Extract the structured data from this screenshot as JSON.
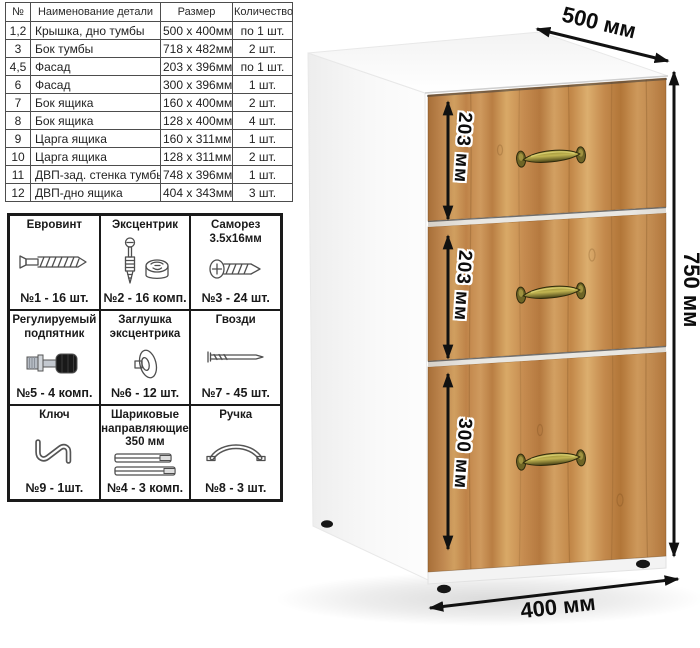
{
  "parts_table": {
    "headers": {
      "num": "№",
      "name": "Наименование детали",
      "size": "Размер",
      "qty": "Количество"
    },
    "rows": [
      {
        "num": "1,2",
        "name": "Крышка, дно тумбы",
        "size": "500 х 400мм",
        "qty": "по 1 шт."
      },
      {
        "num": "3",
        "name": "Бок тумбы",
        "size": "718 х 482мм",
        "qty": "2 шт."
      },
      {
        "num": "4,5",
        "name": "Фасад",
        "size": "203 х 396мм",
        "qty": "по 1 шт."
      },
      {
        "num": "6",
        "name": "Фасад",
        "size": "300 х 396мм",
        "qty": "1 шт."
      },
      {
        "num": "7",
        "name": "Бок ящика",
        "size": "160 х 400мм",
        "qty": "2 шт."
      },
      {
        "num": "8",
        "name": "Бок ящика",
        "size": "128 х 400мм",
        "qty": "4 шт."
      },
      {
        "num": "9",
        "name": "Царга ящика",
        "size": "160 х 311мм",
        "qty": "1 шт."
      },
      {
        "num": "10",
        "name": "Царга ящика",
        "size": "128 х 311мм",
        "qty": "2 шт."
      },
      {
        "num": "11",
        "name": "ДВП-зад. стенка тумбы",
        "size": "748 х 396мм",
        "qty": "1 шт."
      },
      {
        "num": "12",
        "name": "ДВП-дно ящика",
        "size": "404 х 343мм",
        "qty": "3 шт."
      }
    ]
  },
  "hardware_table": {
    "cells": [
      {
        "title": "Евровинт",
        "count": "№1 - 16 шт.",
        "icon": "euroscrew-icon"
      },
      {
        "title": "Эксцентрик",
        "count": "№2 - 16 комп.",
        "icon": "cam-lock-icon"
      },
      {
        "title": "Саморез 3.5х16мм",
        "count": "№3 - 24 шт.",
        "icon": "screw-icon"
      },
      {
        "title": "Регулируемый подпятник",
        "count": "№5 - 4 комп.",
        "icon": "adjustable-foot-icon"
      },
      {
        "title": "Заглушка эксцентрика",
        "count": "№6 - 12 шт.",
        "icon": "cam-cap-icon"
      },
      {
        "title": "Гвозди",
        "count": "№7 - 45 шт.",
        "icon": "nail-icon"
      },
      {
        "title": "Ключ",
        "count": "№9 - 1шт.",
        "icon": "hex-key-icon"
      },
      {
        "title": "Шариковые направляющие 350 мм",
        "count": "№4 - 3 комп.",
        "icon": "ball-slides-icon"
      },
      {
        "title": "Ручка",
        "count": "№8 - 3 шт.",
        "icon": "handle-icon"
      }
    ]
  },
  "drawing": {
    "dim_depth": "500 мм",
    "dim_height": "750 мм",
    "dim_width": "400 мм",
    "dim_drawer1": "203 мм",
    "dim_drawer2": "203 мм",
    "dim_drawer3": "300 мм",
    "colors": {
      "wood_base": "#c98f55",
      "wood_dark": "#a96f38",
      "wood_light": "#dcae6e",
      "handle_brass": "#b3a84c",
      "carcass": "#ffffff",
      "annotation": "#111111"
    }
  }
}
